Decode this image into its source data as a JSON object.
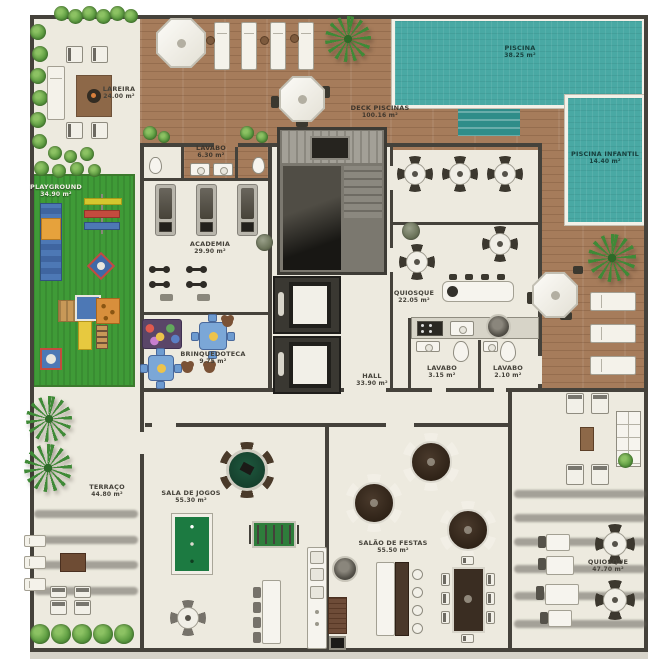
{
  "plan": {
    "title": "condominium-leisure-floor-plan",
    "rooms": {
      "lareira": {
        "name": "LAREIRA",
        "area": "24.00 m²"
      },
      "deck_piscinas": {
        "name": "DECK PISCINAS",
        "area": "100.16 m²"
      },
      "piscina": {
        "name": "PISCINA",
        "area": "38.25 m²"
      },
      "piscina_infantil": {
        "name": "PISCINA INFANTIL",
        "area": "14.40 m²"
      },
      "lavabo_deck": {
        "name": "LAVABO",
        "area": "6.30 m²"
      },
      "playground": {
        "name": "PLAYGROUND",
        "area": "34.90 m²"
      },
      "academia": {
        "name": "ACADEMIA",
        "area": "29.90 m²"
      },
      "brinquedoteca": {
        "name": "BRINQUEDOTECA",
        "area": "9.75 m²"
      },
      "quiosque_interno": {
        "name": "QUIOSQUE",
        "area": "22.05 m²"
      },
      "lavabo_1": {
        "name": "LAVABO",
        "area": "3.15 m²"
      },
      "lavabo_2": {
        "name": "LAVABO",
        "area": "2.10 m²"
      },
      "hall": {
        "name": "HALL",
        "area": "33.90 m²"
      },
      "terraco": {
        "name": "TERRAÇO",
        "area": "44.80 m²"
      },
      "sala_de_jogos": {
        "name": "SALA DE JOGOS",
        "area": "55.30 m²"
      },
      "salao_de_festas": {
        "name": "SALÃO DE FESTAS",
        "area": "55.50 m²"
      },
      "quiosque_externo": {
        "name": "QUIOSQUE",
        "area": "47.70 m²"
      }
    },
    "colors": {
      "floor": "#edeadf",
      "wood_deck": "#a67c5b",
      "pool_water": "#49a9a4",
      "grass": "#3f9b37",
      "wall": "#45423b",
      "billiard_green": "#1c7a41",
      "table_dark_brown": "#3a2d22"
    }
  }
}
